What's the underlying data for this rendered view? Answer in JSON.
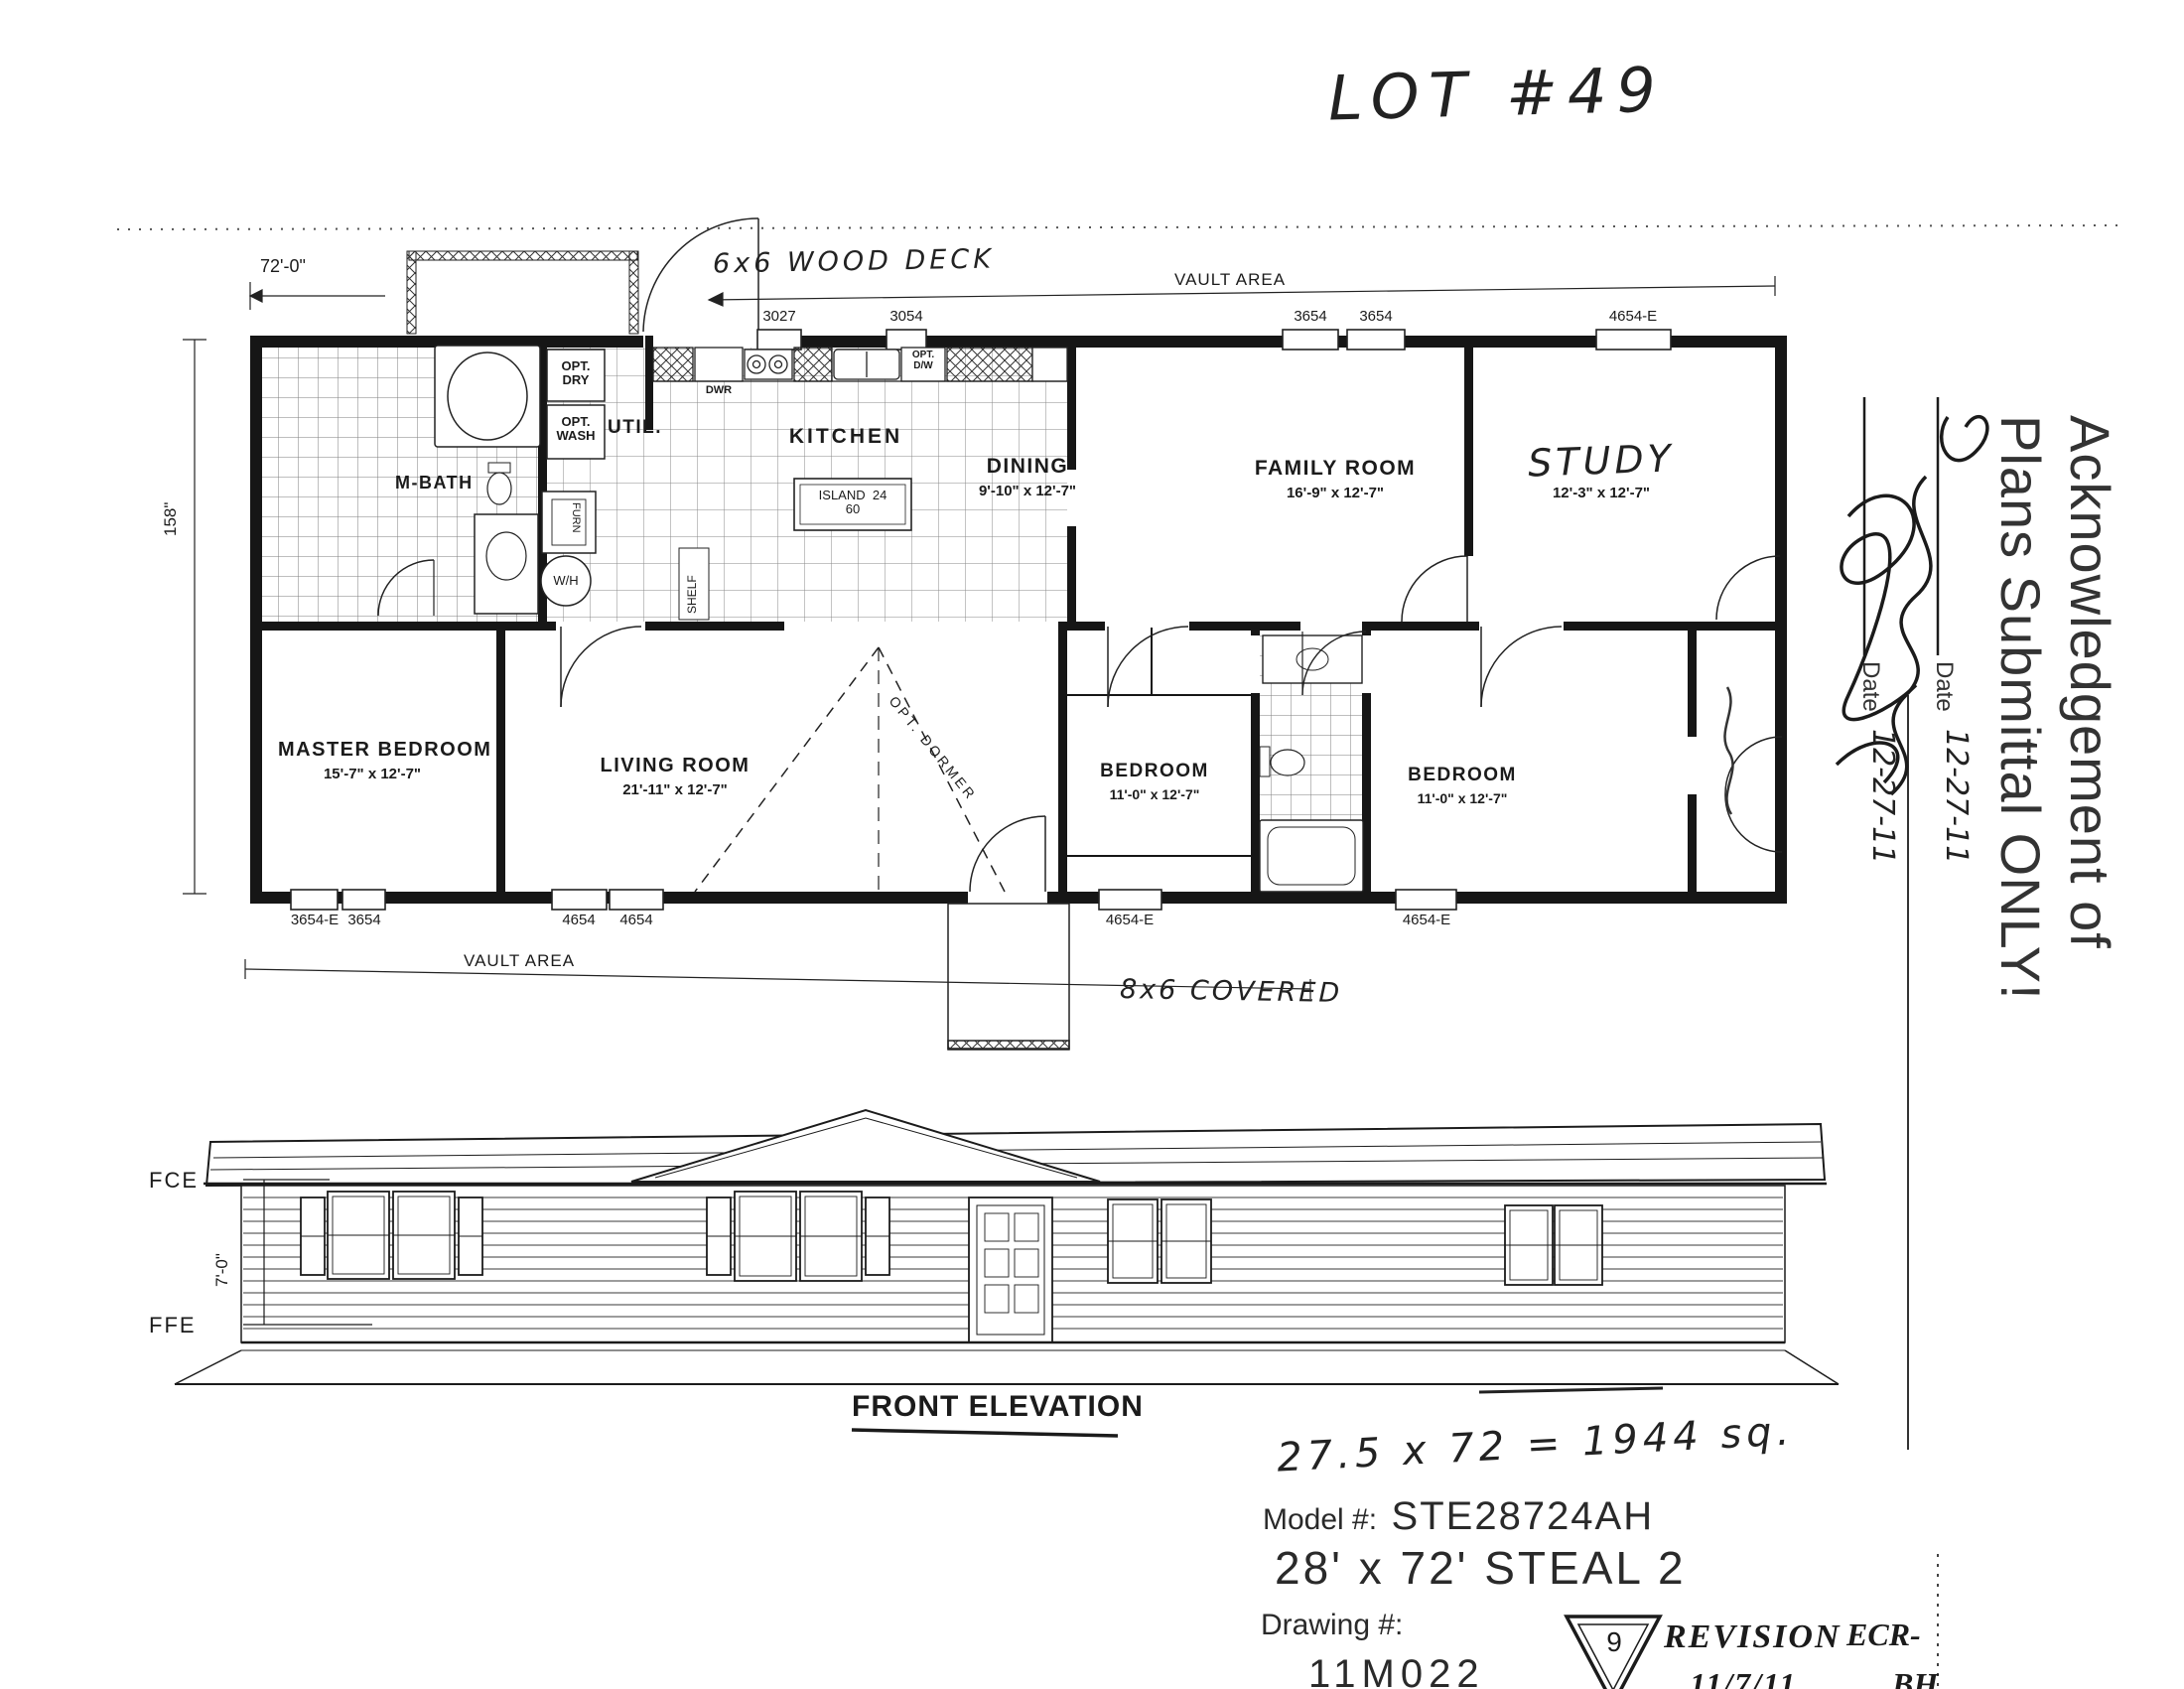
{
  "page": {
    "lot_label": "LOT #49"
  },
  "plan": {
    "deck_note": "6x6 WOOD DECK",
    "vault_area_top": "VAULT AREA",
    "vault_area_bottom": "VAULT AREA",
    "covered_note": "8x6 COVERED",
    "overall_width": "72'-0\"",
    "overall_depth": "158\"",
    "top_window_tags": [
      "3027",
      "3054",
      "3654",
      "3654",
      "4654-E"
    ],
    "bottom_window_tags": [
      "3654-E",
      "3654",
      "4654",
      "4654",
      "4654-E",
      "4654-E"
    ],
    "rooms": [
      {
        "name": "M-BATH",
        "dims": ""
      },
      {
        "name": "UTIL.",
        "dims": ""
      },
      {
        "name": "KITCHEN",
        "dims": ""
      },
      {
        "name": "DINING",
        "dims": "9'-10\" x 12'-7\""
      },
      {
        "name": "FAMILY ROOM",
        "dims": "16'-9\" x 12'-7\""
      },
      {
        "name": "STUDY",
        "dims": "12'-3\" x 12'-7\""
      },
      {
        "name": "MASTER BEDROOM",
        "dims": "15'-7\" x 12'-7\""
      },
      {
        "name": "LIVING ROOM",
        "dims": "21'-11\" x 12'-7\""
      },
      {
        "name": "BEDROOM",
        "dims": "11'-0\" x 12'-7\""
      },
      {
        "name": "BEDROOM",
        "dims": "11'-0\" x 12'-7\""
      }
    ],
    "fixtures": {
      "opt_dry_1": "OPT.",
      "opt_dry_2": "DRY",
      "opt_wash_1": "OPT.",
      "opt_wash_2": "WASH",
      "dwr": "DWR",
      "opt_dw_1": "OPT.",
      "opt_dw_2": "D/W",
      "island_line1": "ISLAND  24",
      "island_line2": "60",
      "shelf": "SHELF",
      "water_heater": "W/H",
      "furnace": "FURN",
      "opt_dormer": "OPT. DORMER"
    }
  },
  "elevation": {
    "title": "FRONT ELEVATION",
    "fce": "FCE",
    "ffe": "FFE",
    "height_dim": "7'-0\""
  },
  "stamp": {
    "line1": "Acknowledgement of",
    "line2": "Plans Submittal ONLY!",
    "date_label_1": "Date",
    "date_value_1": "12-27-11",
    "date_label_2": "Date",
    "date_value_2": "12-27-11"
  },
  "title_block": {
    "area_note": "27.5 x 72 = 1944 sq.",
    "model_label": "Model #:",
    "model_value": "STE28724AH",
    "size_title": "28' x 72' STEAL 2",
    "drawing_label": "Drawing #:",
    "drawing_value": "11M022",
    "revision_number": "9",
    "revision_label": "REVISION",
    "revision_date": "11/7/11",
    "ecr_label": "ECR-",
    "ecr_value": "BH"
  }
}
